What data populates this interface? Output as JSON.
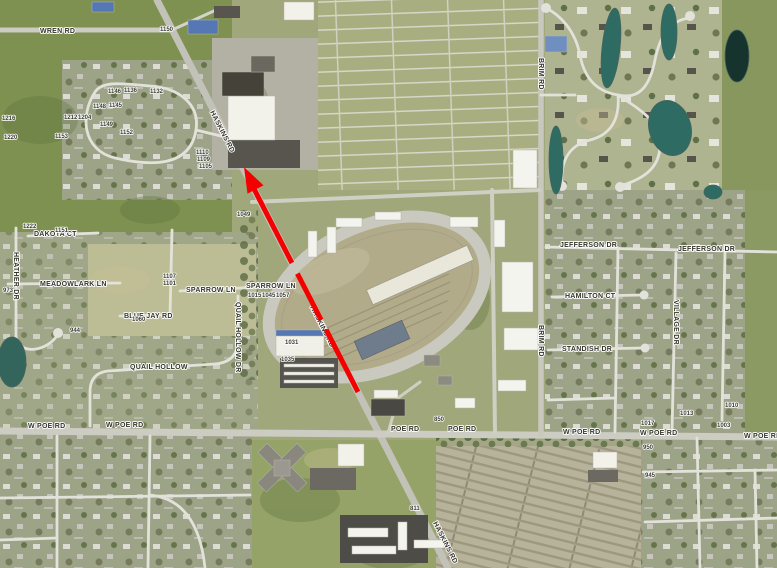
{
  "map": {
    "type": "aerial-orthophoto",
    "description": "Spring aerial imagery of a suburban area: county fairgrounds with oval racetrack and barns in center, gridded overflow parking north of it, cemetery rows southeast, residential subdivisions with ponds around the edges",
    "annotation_arrow": {
      "shape": "dashed red arrow",
      "color": "#f40000",
      "from": "Haskins Rd near Poe Rd intersection",
      "to": "northwest along Haskins Rd toward Wren Rd"
    },
    "colors": {
      "annotation_red": "#f40000",
      "road_gray": "#ccccc2",
      "minor_street": "#e2e2da",
      "field_green": "#7e9150",
      "pond_teal": "#2e6b63",
      "pond_dark": "#16332e",
      "track_ring": "#c9c9c0",
      "infield_dirt": "#b2ab8a"
    }
  },
  "road_labels": [
    {
      "t": "WREN RD"
    },
    {
      "t": "HASKINS RD"
    },
    {
      "t": "HASKINS RD"
    },
    {
      "t": "HASKINS RD"
    },
    {
      "t": "BRIM RD"
    },
    {
      "t": "BRIM RD"
    },
    {
      "t": "W POE RD"
    },
    {
      "t": "W POE RD"
    },
    {
      "t": "POE RD"
    },
    {
      "t": "POE RD"
    },
    {
      "t": "W POE RD"
    },
    {
      "t": "W POE RD"
    },
    {
      "t": "W POE RD"
    },
    {
      "t": "SPARROW LN"
    },
    {
      "t": "SPARROW LN"
    },
    {
      "t": "MEADOWLARK LN"
    },
    {
      "t": "DAKOTA CT"
    },
    {
      "t": "HEATHER DR"
    },
    {
      "t": "BLUE JAY RD"
    },
    {
      "t": "QUAIL HOLLOW DR"
    },
    {
      "t": "QUAIL HOLLOW"
    },
    {
      "t": "JEFFERSON DR"
    },
    {
      "t": "JEFFERSON DR"
    },
    {
      "t": "HAMILTON CT"
    },
    {
      "t": "STANDISH DR"
    },
    {
      "t": "VILLAGE DR"
    }
  ],
  "parcel_labels": [
    {
      "t": "1150"
    },
    {
      "t": "1146"
    },
    {
      "t": "1136"
    },
    {
      "t": "1132"
    },
    {
      "t": "1148"
    },
    {
      "t": "1145"
    },
    {
      "t": "1149"
    },
    {
      "t": "1152"
    },
    {
      "t": "1153"
    },
    {
      "t": "1216"
    },
    {
      "t": "1220"
    },
    {
      "t": "1212"
    },
    {
      "t": "1204"
    },
    {
      "t": "1222"
    },
    {
      "t": "1151"
    },
    {
      "t": "973"
    },
    {
      "t": "944"
    },
    {
      "t": "1107"
    },
    {
      "t": "1101"
    },
    {
      "t": "1060"
    },
    {
      "t": "1049"
    },
    {
      "t": "1015"
    },
    {
      "t": "1045"
    },
    {
      "t": "1057"
    },
    {
      "t": "1031"
    },
    {
      "t": "1035"
    },
    {
      "t": "850"
    },
    {
      "t": "811"
    },
    {
      "t": "1017"
    },
    {
      "t": "1013"
    },
    {
      "t": "1010"
    },
    {
      "t": "1003"
    },
    {
      "t": "950"
    },
    {
      "t": "945"
    },
    {
      "t": "1110"
    },
    {
      "t": "1109"
    },
    {
      "t": "1105"
    }
  ]
}
